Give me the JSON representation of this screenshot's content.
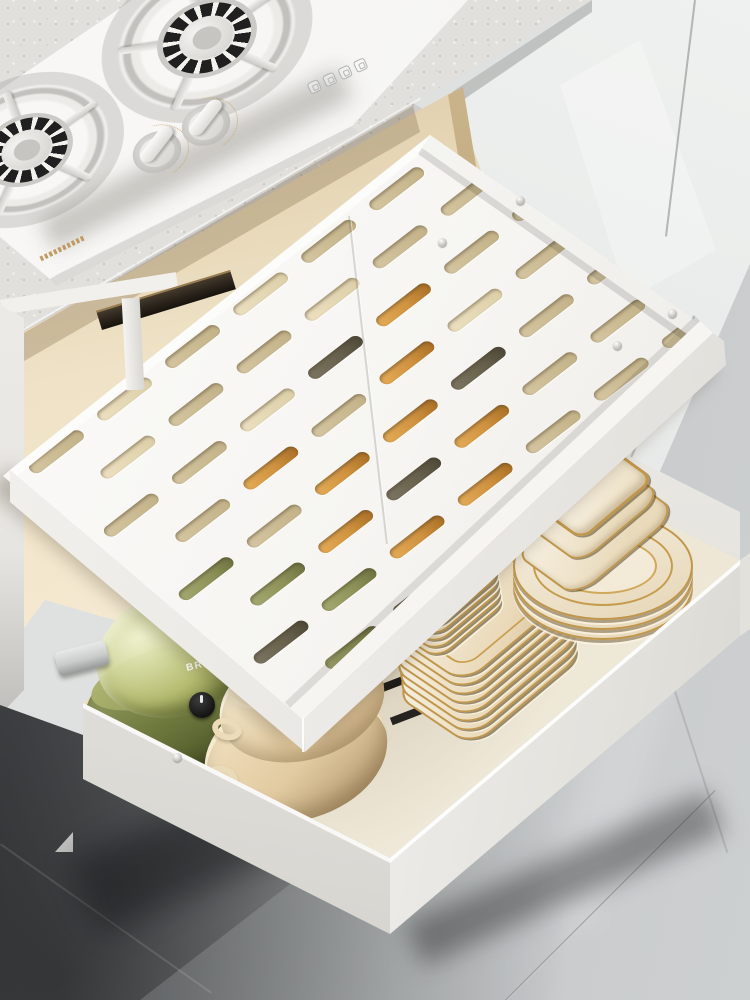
{
  "meta": {
    "media": "product-photo",
    "scene": "Modern kitchen: fully extended two-tier white pull-out drawer organizer under a built-in white gas cooktop; upper tier is a perforated expandable tray, lower tier holds cookware and gold-rimmed dinnerware; grey marble tile floor",
    "interactive_ui": false
  },
  "colors": {
    "counter": "#e1e0dc",
    "counter_edge": "#cfcdc9",
    "stove_white": "#f5f4f2",
    "burner_dark": "#202020",
    "door_grey": "#e7e9e8",
    "cream_interior": "#efe2c6",
    "rail_dark": "#2c251c",
    "rail_brass": "#b3905e",
    "tray_white": "#f6f5f2",
    "slot_pale": "#d4c5a0",
    "slot_bright": "#ecdfbf",
    "slot_dark": "#66604b",
    "slot_amber": "#cf9240",
    "slot_green": "#8d9158",
    "drawer_white": "#f3f2ef",
    "drawer_floor": "#ebe4d2",
    "pot_green": "#6f7a3e",
    "pot_green_dark": "#4d5529",
    "pot_lid_glass": "#b9bf72",
    "handle_grey": "#c9cccb",
    "pot_beige": "#e2cba2",
    "pot_beige_light": "#f4e7cb",
    "dish_cream": "#f4eee0",
    "dish_gold": "#c0964a",
    "floor_dark": "#46494b",
    "floor_light": "#cdd0d1"
  },
  "cooktop": {
    "type": "2-burner gas hob, white glass",
    "burners_visible": 2,
    "knobs": 2,
    "indicator_icons": 4,
    "brand_mark": "small gold logotype on front edge (too small to read)"
  },
  "cabinet": {
    "door_panels_visible": 2,
    "counter_material": "speckled stone"
  },
  "organizer": {
    "tiers": 2,
    "upper_tray": {
      "style": "expandable perforated sliding tray",
      "slot_rows": [
        {
          "y": 26,
          "x0": 20,
          "gap": 86,
          "variants": "pbpbppb"
        },
        {
          "y": 74,
          "x0": 63,
          "gap": 86,
          "variants": "bppbpp"
        },
        {
          "y": 122,
          "x0": 20,
          "gap": 86,
          "variants": "ppbdapp"
        },
        {
          "y": 170,
          "x0": 63,
          "gap": 86,
          "variants": "papabp"
        },
        {
          "y": 218,
          "x0": 20,
          "gap": 86,
          "variants": "gpaadpp"
        },
        {
          "y": 266,
          "x0": 63,
          "gap": 86,
          "variants": "gadapp"
        },
        {
          "y": 314,
          "x0": 20,
          "gap": 86,
          "variants": "dgaappp"
        },
        {
          "y": 362,
          "x0": 63,
          "gap": 86,
          "variants": "gdappb"
        }
      ],
      "screws": [
        [
          442,
          242
        ],
        [
          520,
          200
        ],
        [
          617,
          345
        ],
        [
          672,
          313
        ]
      ],
      "has_center_seam": true
    },
    "lower_drawer": {
      "style": "deep pull-out drawer",
      "screws": [
        [
          177,
          757
        ]
      ]
    }
  },
  "cookware": {
    "green_pot": {
      "type": "electric cooker with glass lid",
      "label_fragment": "BRA",
      "has_dial": true
    },
    "beige_pots": {
      "count": 2,
      "style": "stacked pans with loop handles"
    }
  },
  "dinnerware": {
    "rim": "gold",
    "square_plates": 8,
    "small_square_plates": 5,
    "round_plates": 3,
    "nested_square_bowls": 3,
    "rect_bowl": 1,
    "small_round_bowls": 2,
    "small_square_bowls": 2
  },
  "floor": {
    "finish": "polished marble tile",
    "left_shade": "dark grey",
    "right_shade": "light grey"
  }
}
